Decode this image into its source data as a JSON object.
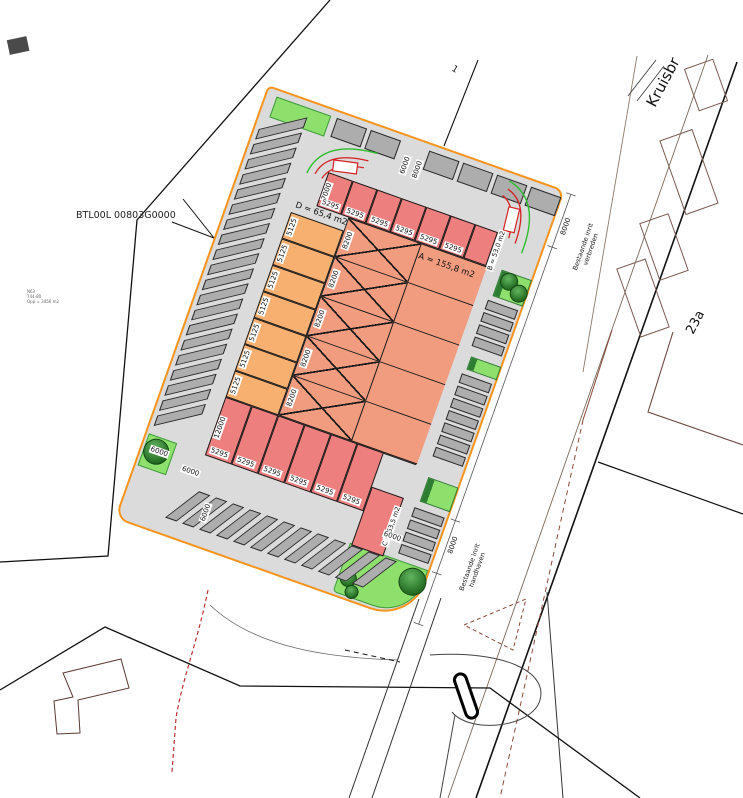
{
  "colors": {
    "boundary_orange": "#F7941D",
    "unit_red": "#EE7F7F",
    "unit_salmon": "#F19B7F",
    "unit_orange": "#F7B070",
    "pavement_gray": "#DBDBDB",
    "stall_gray": "#ADADAD",
    "green_light": "#8CE06B",
    "green_dark": "#2F7D32",
    "turning_red": "#D42020",
    "turning_green": "#2DBE2D",
    "dashed_red": "#C03030"
  },
  "labels": {
    "site_code": "BTL00L 00803G0000",
    "street_name": "Kruisbr",
    "parcel_number": "23a",
    "point_marker": "1",
    "area_a": "A = 155,8 m2",
    "area_b": "B = 53,0 m2",
    "area_c": "C = 63,5 m2",
    "area_d": "D = 65,4 m2",
    "note_top_line1": "Bestaande inrit",
    "note_top_line2": "verbreden",
    "note_bottom_line1": "Bestaande inrit",
    "note_bottom_line2": "handhaven",
    "tiny_block": [
      "N63",
      "744-80",
      "Opp = 3456 m2"
    ]
  },
  "units": {
    "top": {
      "count": 6,
      "width_label": "5295",
      "depth_label": "7000"
    },
    "left": {
      "count": 7,
      "width_label": "5125"
    },
    "mid": {
      "count": 5,
      "width_label": "8200"
    },
    "bottom": {
      "count": 6,
      "width_label": "5295",
      "depth_label": "12000"
    }
  },
  "dims": {
    "top": [
      "6000",
      "8000"
    ],
    "right": [
      "8000",
      "8000"
    ],
    "bottom": [
      "6000",
      "6000",
      "6000",
      "6000"
    ]
  },
  "parking": {
    "left": 20,
    "bottom": 12,
    "top_left": 2,
    "top_right": 4,
    "right_top": 4,
    "right_mid": 7,
    "right_bottom": 4
  }
}
